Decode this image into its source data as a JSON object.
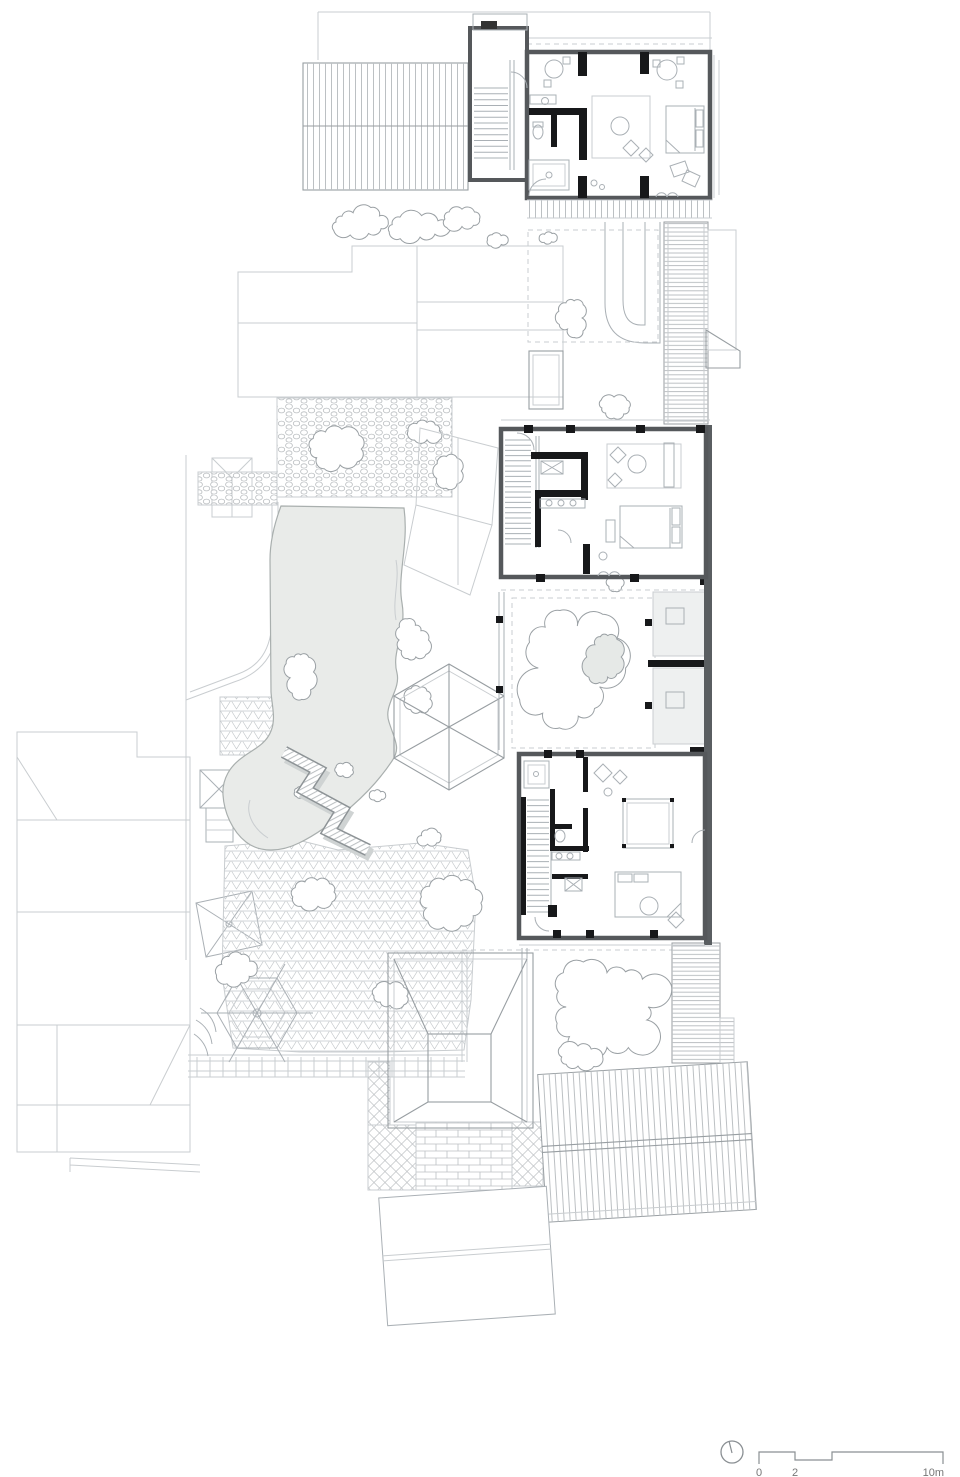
{
  "drawing": {
    "kind": "architectural ground floor plan",
    "features": [
      "guest-house rooms",
      "courtyard pond",
      "zigzag bridge",
      "pavilion roofs",
      "garden rockery",
      "paved courtyards"
    ]
  },
  "scale_bar": {
    "zero": "0",
    "two": "2",
    "ten": "10m"
  },
  "north_indicator": {
    "icon": "compass-circle-icon"
  },
  "colors": {
    "paper": "#ffffff",
    "faint_line": "#c9cdd0",
    "light_line": "#aab0b5",
    "mid_line": "#989ea2",
    "wall_gray": "#55585b",
    "black_wall": "#17181a",
    "water_fill": "#e9ebe9",
    "water_line": "#a9afae",
    "floor_fill": "#eef0f0",
    "pattern_line": "#bcc0c3",
    "text": "#777777"
  }
}
